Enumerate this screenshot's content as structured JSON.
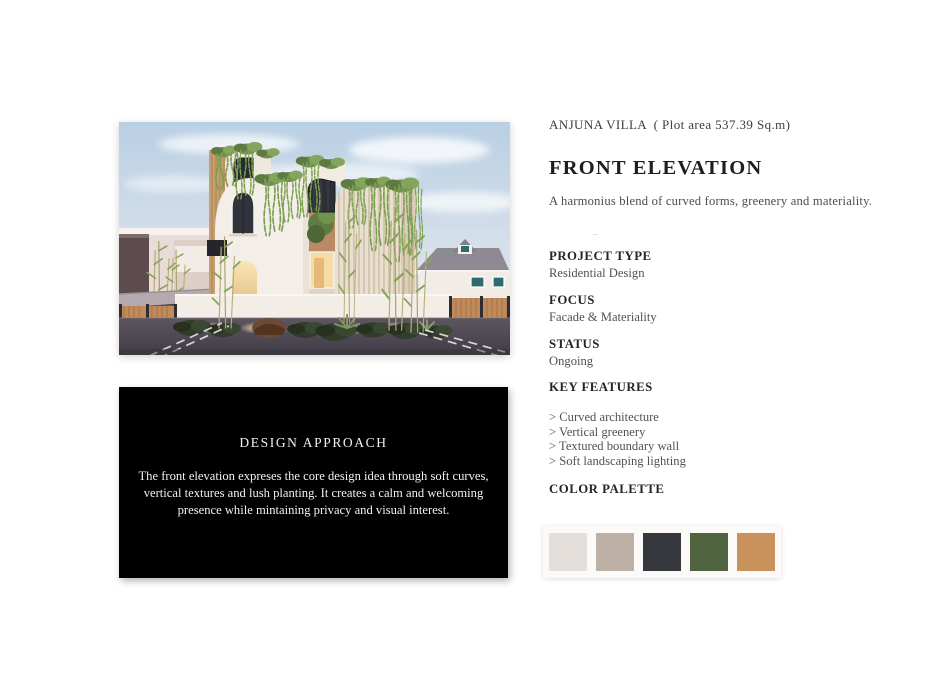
{
  "header": {
    "project_line": "ANJUNA VILLA  ( Plot area 537.39 Sq.m)",
    "title": "FRONT ELEVATION",
    "subtitle": "A harmonius blend of curved forms, greenery and materiality.",
    "divider": "–"
  },
  "details": [
    {
      "label": "PROJECT TYPE",
      "value": "Residential Design"
    },
    {
      "label": "FOCUS",
      "value": "Facade & Materiality"
    },
    {
      "label": "STATUS",
      "value": "Ongoing"
    }
  ],
  "key_features": {
    "label": "KEY FEATURES",
    "items": [
      "> Curved architecture",
      "> Vertical greenery",
      "> Textured boundary wall",
      "> Soft landscaping lighting"
    ]
  },
  "color_palette": {
    "label": "COLOR PALETTE",
    "swatches": [
      {
        "name": "off-white",
        "hex": "#e4dfda"
      },
      {
        "name": "taupe",
        "hex": "#bdb0a5"
      },
      {
        "name": "charcoal",
        "hex": "#35383d"
      },
      {
        "name": "olive-green",
        "hex": "#50653f"
      },
      {
        "name": "terracotta",
        "hex": "#c9915c"
      }
    ]
  },
  "design_approach": {
    "title": "DESIGN APPROACH",
    "body": "The front elevation expreses the core design idea through soft curves, vertical textures and lush planting. It creates a calm and welcoming presence while mintaining privacy and visual interest."
  }
}
